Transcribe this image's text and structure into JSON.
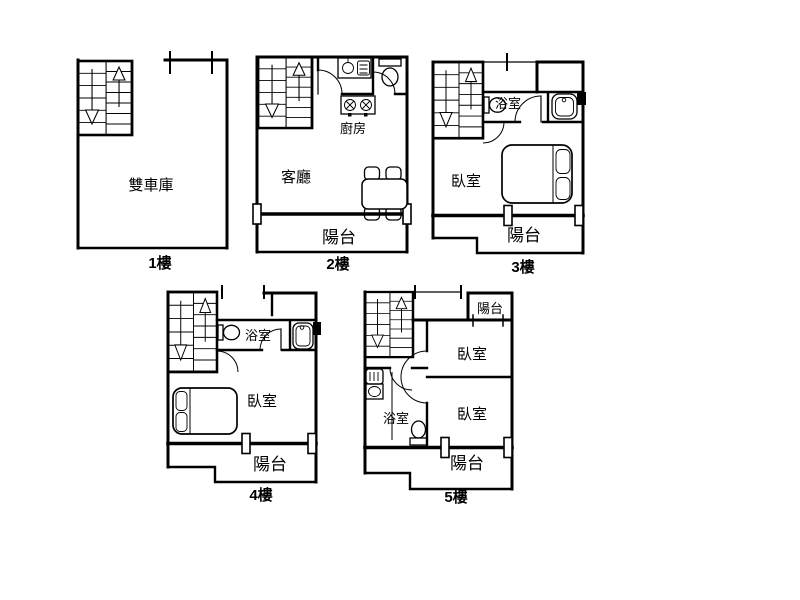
{
  "colors": {
    "line": "#000000",
    "background": "#ffffff"
  },
  "floors": [
    {
      "caption": "1樓",
      "rooms": [
        {
          "name": "double-garage",
          "label": "雙車庫"
        }
      ]
    },
    {
      "caption": "2樓",
      "rooms": [
        {
          "name": "living-room",
          "label": "客廳"
        },
        {
          "name": "kitchen",
          "label": "廚房"
        },
        {
          "name": "balcony",
          "label": "陽台"
        }
      ]
    },
    {
      "caption": "3樓",
      "rooms": [
        {
          "name": "bathroom",
          "label": "浴室"
        },
        {
          "name": "bedroom",
          "label": "臥室"
        },
        {
          "name": "balcony",
          "label": "陽台"
        }
      ]
    },
    {
      "caption": "4樓",
      "rooms": [
        {
          "name": "bathroom",
          "label": "浴室"
        },
        {
          "name": "bedroom",
          "label": "臥室"
        },
        {
          "name": "balcony",
          "label": "陽台"
        }
      ]
    },
    {
      "caption": "5樓",
      "rooms": [
        {
          "name": "balcony-upper",
          "label": "陽台"
        },
        {
          "name": "bedroom-a",
          "label": "臥室"
        },
        {
          "name": "bedroom-b",
          "label": "臥室"
        },
        {
          "name": "bathroom",
          "label": "浴室"
        },
        {
          "name": "balcony-lower",
          "label": "陽台"
        }
      ]
    }
  ]
}
